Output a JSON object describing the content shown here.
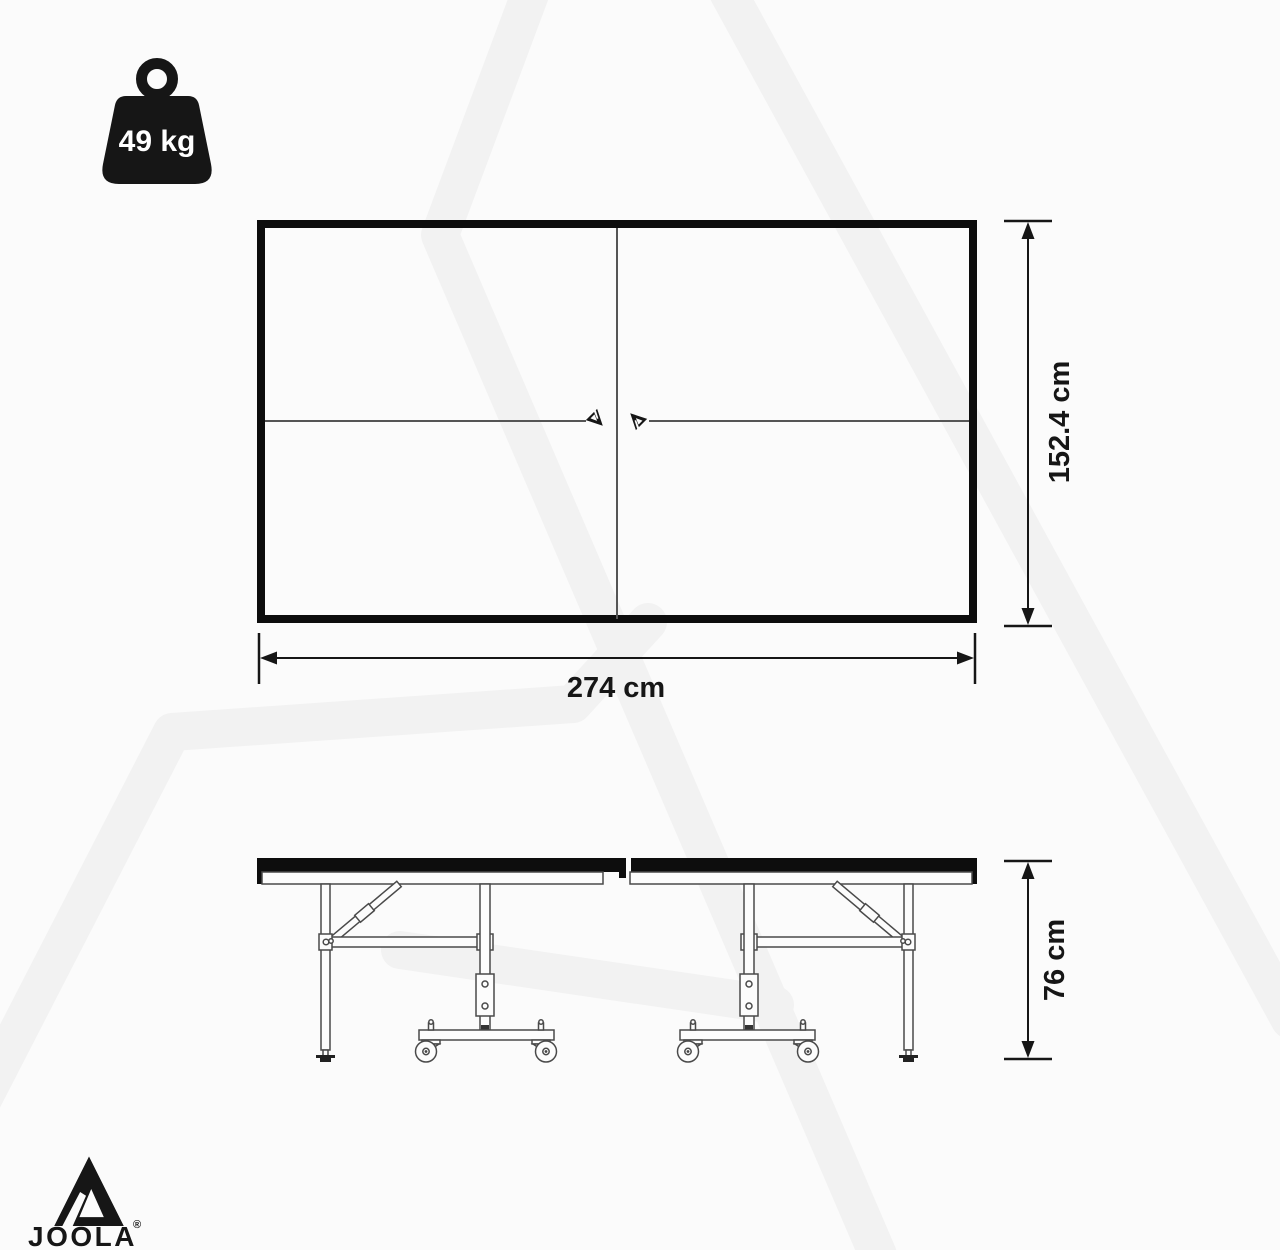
{
  "weight_badge": {
    "label": "49 kg"
  },
  "dimensions": {
    "table_width": "274 cm",
    "table_height": "152.4 cm",
    "table_standing_height": "76 cm"
  },
  "brand": {
    "wordmark": "JOOLA",
    "registered_mark": "®"
  },
  "icons": {
    "weight": "kettlebell-weight-icon",
    "brand_triangle": "joola-triangle-icon",
    "center_marks": "joola-triangle-mini-icons"
  },
  "colors": {
    "ink": "#161616",
    "drawing_line": "#4a4a4a",
    "watermark": "#f2f2f2",
    "background": "#fbfbfb",
    "badge_text": "#ffffff"
  }
}
